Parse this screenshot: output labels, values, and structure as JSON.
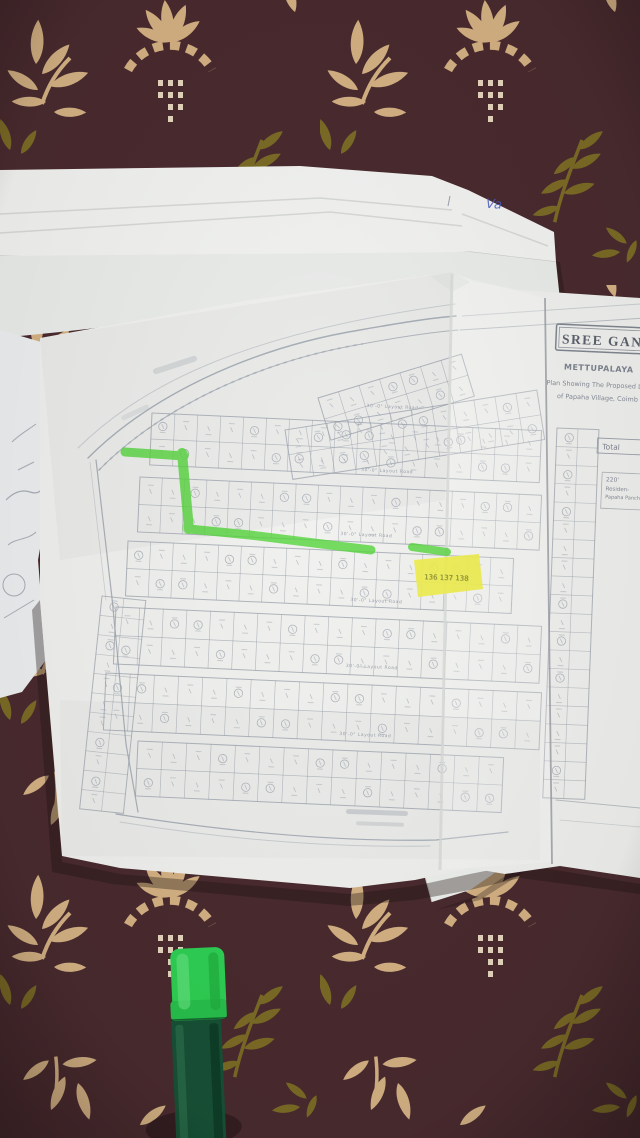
{
  "photo": {
    "handwritten_note": "Va"
  },
  "map": {
    "title_stamp": "SREE GANA",
    "subtitle": "METTUPALAYA",
    "heading_line1": "Plan Showing The Proposed La",
    "heading_line2": "of Papaha Village, Coimb",
    "total_label": "Total",
    "info_box_lines": [
      "220'",
      "Residen-",
      "Papaha Panch"
    ],
    "road_label": "30'-0\" Layout Road",
    "highlight_numbers": "136  137  138"
  },
  "highlights": {
    "marker_green": "#55d43c",
    "patch_yellow": "#eeed4d"
  },
  "pen": {
    "cap_color": "#2fd054",
    "body_color": "#175136"
  },
  "fabric": {
    "background": "#4a2b2f",
    "leaf_tan": "#d5b284",
    "leaf_olive": "#7c6b26"
  }
}
